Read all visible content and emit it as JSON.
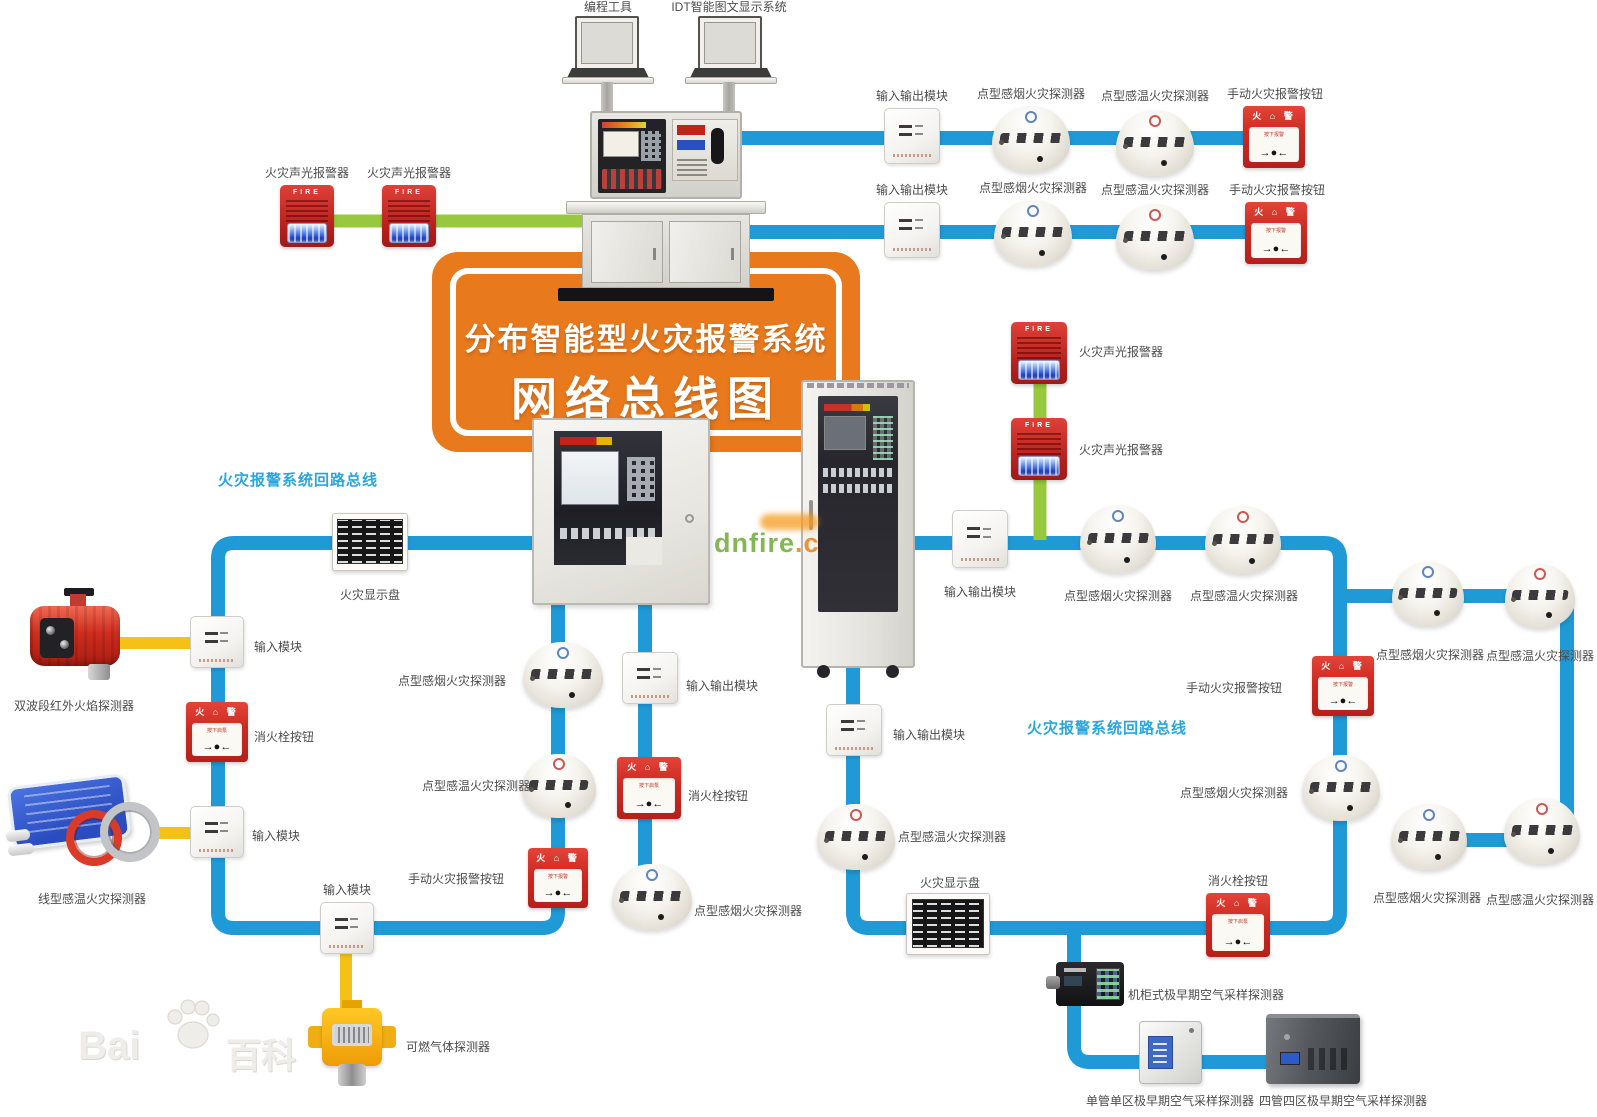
{
  "banner": {
    "line1": "分布智能型火灾报警系统",
    "line2": "网络总线图",
    "bg": "#e8791d"
  },
  "colors": {
    "blue": "#1f9ad7",
    "green": "#97c83d",
    "yellow": "#f5c117"
  },
  "device_art": {
    "sounder_text": "FIRE",
    "callpoint_top": "火 ⌂ 警",
    "callpoint_press": "按下报警",
    "hydrant_press": "按下启泵",
    "arrows": "→●←"
  },
  "watermarks": {
    "baidu": {
      "part1": "Bai",
      "part2": "百科"
    },
    "dnfire": {
      "part1": "dnfire",
      "part2": ".c"
    }
  },
  "lines": [
    {
      "c": "green",
      "w": 13,
      "p": [
        [
          288,
          221
        ],
        [
          592,
          221
        ]
      ]
    },
    {
      "c": "blue",
      "w": 14,
      "p": [
        [
          736,
          138
        ],
        [
          1300,
          138
        ]
      ]
    },
    {
      "c": "blue",
      "w": 14,
      "p": [
        [
          736,
          232
        ],
        [
          1300,
          232
        ]
      ]
    },
    {
      "c": "blue",
      "w": 14,
      "p": [
        [
          532,
          543
        ],
        [
          218,
          543
        ],
        [
          218,
          928
        ],
        [
          558,
          928
        ],
        [
          558,
          600
        ]
      ]
    },
    {
      "c": "blue",
      "w": 14,
      "p": [
        [
          645,
          600
        ],
        [
          645,
          878
        ]
      ]
    },
    {
      "c": "blue",
      "w": 14,
      "p": [
        [
          853,
          662
        ],
        [
          853,
          928
        ],
        [
          1340,
          928
        ],
        [
          1340,
          543
        ],
        [
          908,
          543
        ]
      ]
    },
    {
      "c": "blue",
      "w": 14,
      "p": [
        [
          1340,
          596
        ],
        [
          1567,
          596
        ],
        [
          1567,
          840
        ],
        [
          1404,
          840
        ]
      ]
    },
    {
      "c": "green",
      "w": 13,
      "p": [
        [
          1040,
          348
        ],
        [
          1040,
          540
        ]
      ]
    },
    {
      "c": "blue",
      "w": 14,
      "p": [
        [
          1074,
          928
        ],
        [
          1074,
          1062
        ],
        [
          1294,
          1062
        ]
      ]
    },
    {
      "c": "yellow",
      "w": 12,
      "p": [
        [
          112,
          643
        ],
        [
          217,
          643
        ]
      ]
    },
    {
      "c": "yellow",
      "w": 12,
      "p": [
        [
          155,
          833
        ],
        [
          217,
          833
        ]
      ]
    },
    {
      "c": "yellow",
      "w": 12,
      "p": [
        [
          346,
          950
        ],
        [
          346,
          1008
        ]
      ]
    }
  ],
  "nodes": [
    {
      "t": "text",
      "n": "label-programming-tool",
      "label": "编程工具",
      "l": [
        566,
        1,
        84,
        "c"
      ]
    },
    {
      "t": "text",
      "n": "label-idt-display-system",
      "label": "IDT智能图文显示系统",
      "l": [
        662,
        1,
        134,
        "c"
      ]
    },
    {
      "t": "laptop",
      "n": "laptop-programming",
      "d": [
        565,
        16,
        86,
        68
      ]
    },
    {
      "t": "laptop",
      "n": "laptop-idt",
      "d": [
        688,
        16,
        86,
        68
      ]
    },
    {
      "t": "pole",
      "n": "laptop-pole",
      "d": [
        601,
        82,
        12,
        30
      ]
    },
    {
      "t": "pole",
      "n": "laptop-pole",
      "d": [
        723,
        82,
        12,
        30
      ]
    },
    {
      "t": "console",
      "n": "control-console",
      "d": [
        566,
        105,
        200,
        196
      ]
    },
    {
      "t": "sounder",
      "n": "sounder-strobe",
      "label": "火灾声光报警器",
      "d": [
        280,
        185,
        54,
        62
      ],
      "l": [
        260,
        167,
        94,
        "c"
      ]
    },
    {
      "t": "sounder",
      "n": "sounder-strobe",
      "label": "火灾声光报警器",
      "d": [
        382,
        185,
        54,
        62
      ],
      "l": [
        362,
        167,
        94,
        "c"
      ]
    },
    {
      "t": "module",
      "n": "io-module",
      "label": "输入输出模块",
      "d": [
        884,
        108,
        56,
        56
      ],
      "l": [
        856,
        90,
        112,
        "c"
      ]
    },
    {
      "t": "smoke",
      "n": "smoke-detector",
      "label": "点型感烟火灾探测器",
      "d": [
        992,
        106,
        78,
        66
      ],
      "l": [
        976,
        88,
        110,
        "c"
      ]
    },
    {
      "t": "heat",
      "n": "heat-detector",
      "label": "点型感温火灾探测器",
      "d": [
        1116,
        110,
        78,
        66
      ],
      "l": [
        1100,
        90,
        110,
        "c"
      ]
    },
    {
      "t": "callpoint",
      "n": "manual-call-point",
      "label": "手动火灾报警按钮",
      "d": [
        1243,
        106,
        62,
        62
      ],
      "l": [
        1219,
        88,
        112,
        "c"
      ]
    },
    {
      "t": "module",
      "n": "io-module",
      "label": "输入输出模块",
      "d": [
        884,
        202,
        56,
        56
      ],
      "l": [
        856,
        184,
        112,
        "c"
      ]
    },
    {
      "t": "smoke",
      "n": "smoke-detector",
      "label": "点型感烟火灾探测器",
      "d": [
        994,
        200,
        78,
        66
      ],
      "l": [
        978,
        182,
        110,
        "c"
      ]
    },
    {
      "t": "heat",
      "n": "heat-detector",
      "label": "点型感温火灾探测器",
      "d": [
        1116,
        204,
        78,
        66
      ],
      "l": [
        1100,
        184,
        110,
        "c"
      ]
    },
    {
      "t": "callpoint",
      "n": "manual-call-point",
      "label": "手动火灾报警按钮",
      "d": [
        1245,
        202,
        62,
        62
      ],
      "l": [
        1221,
        184,
        112,
        "c"
      ]
    },
    {
      "t": "wallpanel",
      "n": "fire-alarm-control-panel",
      "d": [
        532,
        418,
        178,
        187
      ]
    },
    {
      "t": "rack",
      "n": "rack-cabinet-panel",
      "d": [
        801,
        380,
        114,
        298
      ]
    },
    {
      "t": "display",
      "n": "fire-display-panel",
      "label": "火灾显示盘",
      "d": [
        332,
        513,
        76,
        58
      ],
      "l": [
        334,
        589,
        72,
        "c"
      ]
    },
    {
      "t": "module",
      "n": "input-module",
      "label": "输入模块",
      "d": [
        190,
        616,
        54,
        52
      ],
      "l": [
        254,
        641,
        64,
        "l"
      ]
    },
    {
      "t": "flame",
      "n": "ir-flame-detector",
      "label": "双波段红外火焰探测器",
      "d": [
        30,
        588,
        90,
        102
      ],
      "l": [
        14,
        700,
        144,
        "l"
      ]
    },
    {
      "t": "hydrant",
      "n": "hydrant-button",
      "label": "消火栓按钮",
      "d": [
        186,
        702,
        62,
        60
      ],
      "l": [
        254,
        731,
        76,
        "l"
      ]
    },
    {
      "t": "module",
      "n": "input-module",
      "label": "输入模块",
      "d": [
        190,
        806,
        54,
        52
      ],
      "l": [
        252,
        830,
        64,
        "l"
      ]
    },
    {
      "t": "linear",
      "n": "linear-heat-detector",
      "label": "线型感温火灾探测器",
      "d": [
        10,
        780,
        152,
        98
      ],
      "l": [
        38,
        893,
        132,
        "l"
      ]
    },
    {
      "t": "module",
      "n": "input-module",
      "label": "输入模块",
      "d": [
        320,
        902,
        54,
        52
      ],
      "l": [
        316,
        884,
        62,
        "c"
      ]
    },
    {
      "t": "gas",
      "n": "gas-detector",
      "label": "可燃气体探测器",
      "d": [
        306,
        1000,
        92,
        86
      ],
      "l": [
        406,
        1041,
        100,
        "l"
      ]
    },
    {
      "t": "smoke",
      "n": "smoke-detector",
      "label": "点型感烟火灾探测器",
      "d": [
        523,
        642,
        80,
        66
      ],
      "l": [
        398,
        675,
        110,
        "l"
      ]
    },
    {
      "t": "heat",
      "n": "heat-detector",
      "label": "点型感温火灾探测器",
      "d": [
        522,
        754,
        74,
        64
      ],
      "l": [
        422,
        780,
        110,
        "l"
      ]
    },
    {
      "t": "callpoint",
      "n": "manual-call-point",
      "label": "手动火灾报警按钮",
      "d": [
        528,
        848,
        60,
        60
      ],
      "l": [
        408,
        873,
        110,
        "l"
      ]
    },
    {
      "t": "module",
      "n": "io-module",
      "label": "输入输出模块",
      "d": [
        622,
        652,
        56,
        52
      ],
      "l": [
        686,
        680,
        92,
        "l"
      ]
    },
    {
      "t": "hydrant",
      "n": "hydrant-button",
      "label": "消火栓按钮",
      "d": [
        617,
        757,
        64,
        62
      ],
      "l": [
        688,
        790,
        76,
        "l"
      ]
    },
    {
      "t": "smoke",
      "n": "smoke-detector",
      "label": "点型感烟火灾探测器",
      "d": [
        612,
        864,
        80,
        66
      ],
      "l": [
        694,
        905,
        112,
        "l"
      ]
    },
    {
      "t": "sounder",
      "n": "sounder-strobe",
      "label": "火灾声光报警器",
      "d": [
        1011,
        322,
        56,
        62
      ],
      "l": [
        1079,
        346,
        94,
        "l"
      ]
    },
    {
      "t": "sounder",
      "n": "sounder-strobe",
      "label": "火灾声光报警器",
      "d": [
        1011,
        418,
        56,
        62
      ],
      "l": [
        1079,
        444,
        94,
        "l"
      ]
    },
    {
      "t": "module",
      "n": "io-module",
      "label": "输入输出模块",
      "d": [
        952,
        510,
        56,
        58
      ],
      "l": [
        924,
        586,
        112,
        "c"
      ]
    },
    {
      "t": "smoke",
      "n": "smoke-detector",
      "label": "点型感烟火灾探测器",
      "d": [
        1080,
        505,
        76,
        68
      ],
      "l": [
        1062,
        590,
        112,
        "c"
      ]
    },
    {
      "t": "heat",
      "n": "heat-detector",
      "label": "点型感温火灾探测器",
      "d": [
        1205,
        506,
        76,
        68
      ],
      "l": [
        1188,
        590,
        112,
        "c"
      ]
    },
    {
      "t": "module",
      "n": "io-module",
      "label": "输入输出模块",
      "d": [
        826,
        704,
        56,
        52
      ],
      "l": [
        893,
        729,
        92,
        "l"
      ]
    },
    {
      "t": "heat",
      "n": "heat-detector",
      "label": "点型感温火灾探测器",
      "d": [
        817,
        804,
        78,
        66
      ],
      "l": [
        898,
        831,
        112,
        "l"
      ]
    },
    {
      "t": "callpoint",
      "n": "manual-call-point",
      "label": "手动火灾报警按钮",
      "d": [
        1312,
        656,
        62,
        60
      ],
      "l": [
        1170,
        682,
        112,
        "r"
      ]
    },
    {
      "t": "smoke",
      "n": "smoke-detector",
      "label": "点型感烟火灾探测器",
      "d": [
        1302,
        755,
        78,
        66
      ],
      "l": [
        1176,
        787,
        112,
        "r"
      ]
    },
    {
      "t": "smoke",
      "n": "smoke-detector",
      "label": "点型感烟火灾探测器",
      "d": [
        1392,
        562,
        72,
        64
      ],
      "l": [
        1376,
        649,
        108,
        "c"
      ]
    },
    {
      "t": "heat",
      "n": "heat-detector",
      "label": "点型感温火灾探测器",
      "d": [
        1505,
        564,
        70,
        64
      ],
      "l": [
        1486,
        650,
        108,
        "c"
      ]
    },
    {
      "t": "smoke",
      "n": "smoke-detector",
      "label": "点型感烟火灾探测器",
      "d": [
        1391,
        804,
        76,
        66
      ],
      "l": [
        1372,
        892,
        110,
        "c"
      ]
    },
    {
      "t": "heat",
      "n": "heat-detector",
      "label": "点型感温火灾探测器",
      "d": [
        1504,
        798,
        76,
        66
      ],
      "l": [
        1485,
        894,
        110,
        "c"
      ]
    },
    {
      "t": "display",
      "n": "fire-display-panel",
      "label": "火灾显示盘",
      "d": [
        906,
        893,
        84,
        62
      ],
      "l": [
        912,
        877,
        76,
        "c"
      ]
    },
    {
      "t": "hydrant",
      "n": "hydrant-button",
      "label": "消火栓按钮",
      "d": [
        1206,
        893,
        64,
        64
      ],
      "l": [
        1200,
        875,
        76,
        "c"
      ]
    },
    {
      "t": "asdblack",
      "n": "asd-cabinet-type",
      "label": "机柜式极早期空气采样探测器",
      "d": [
        1046,
        960,
        78,
        52
      ],
      "l": [
        1128,
        989,
        172,
        "l"
      ]
    },
    {
      "t": "asdwhite",
      "n": "asd-single-pipe-single-zone",
      "label": "单管单区极早期空气采样探测器",
      "d": [
        1139,
        1021,
        63,
        63
      ],
      "l": [
        1080,
        1095,
        180,
        "c"
      ]
    },
    {
      "t": "asddark",
      "n": "asd-four-pipe-four-zone",
      "label": "四管四区极早期空气采样探测器",
      "d": [
        1266,
        1014,
        94,
        70
      ],
      "l": [
        1250,
        1095,
        186,
        "c"
      ]
    },
    {
      "t": "text",
      "n": "label-left-loop-bus",
      "s": "loop",
      "label": "火灾报警系统回路总线",
      "l": [
        218,
        474,
        190,
        "l"
      ]
    },
    {
      "t": "text",
      "n": "label-right-loop-bus",
      "s": "loop",
      "label": "火灾报警系统回路总线",
      "l": [
        1027,
        722,
        190,
        "l"
      ]
    }
  ]
}
